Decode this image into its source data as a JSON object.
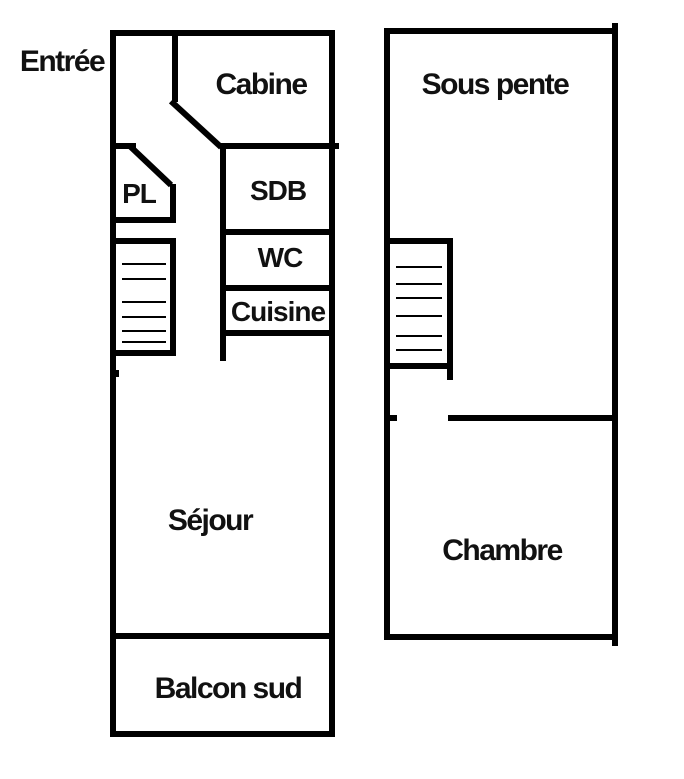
{
  "diagram_type": "floor-plan",
  "colors": {
    "wall": "#000000",
    "background": "#ffffff",
    "text": "#111111"
  },
  "plans": {
    "level1": {
      "rooms": {
        "entree": "Entrée",
        "cabine": "Cabine",
        "pl": "PL",
        "sdb": "SDB",
        "wc": "WC",
        "cuisine": "Cuisine",
        "sejour": "Séjour",
        "balcon_sud": "Balcon sud"
      },
      "stairs_treads": 6
    },
    "level2": {
      "rooms": {
        "sous_pente": "Sous pente",
        "chambre": "Chambre"
      },
      "stairs_treads": 6
    }
  }
}
